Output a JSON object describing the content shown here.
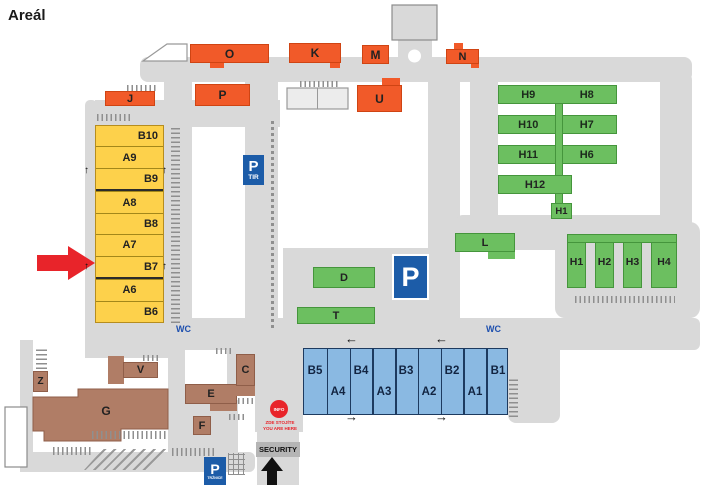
{
  "title": "Areál",
  "halls": {
    "orange": {
      "j": "J",
      "o": "O",
      "k": "K",
      "m": "M",
      "n": "N",
      "p": "P",
      "u": "U"
    },
    "yellow_rows": [
      "B10",
      "A9",
      "B9",
      "A8",
      "B8",
      "A7",
      "B7",
      "A6",
      "B6"
    ],
    "green": {
      "row1_left": "H9",
      "row1_right": "H8",
      "row2_left": "H10",
      "row2_right": "H7",
      "row3_left": "H11",
      "row3_right": "H6",
      "row4": "H12",
      "h1_small": "H1",
      "l": "L",
      "d": "D",
      "t": "T",
      "comb": [
        "H1",
        "H2",
        "H3",
        "H4"
      ]
    },
    "blue_sections": [
      "B5",
      "A4",
      "B4",
      "A3",
      "B3",
      "A2",
      "B2",
      "A1",
      "B1"
    ],
    "brown": {
      "z": "Z",
      "v": "V",
      "g": "G",
      "e": "E",
      "c": "C",
      "f": "F"
    }
  },
  "signs": {
    "parking_tir": {
      "symbol": "P",
      "caption": "TIR"
    },
    "parking_main": {
      "symbol": "P"
    },
    "parking_entrance": {
      "symbol": "P",
      "caption": "TRŽNICE"
    },
    "security": "SECURITY",
    "info": {
      "badge": "INFO",
      "line1": "ZDE STOJÍTE",
      "line2": "YOU ARE HERE"
    },
    "wc_left": "WC",
    "wc_right": "WC"
  },
  "icons": {
    "up_arrow": "↑",
    "left_arrow": "←",
    "right_arrow": "→"
  },
  "colors": {
    "orange": "#f15a29",
    "yellow": "#fdd14b",
    "green": "#6cbf60",
    "blue_hall": "#8ab9e2",
    "brown": "#b07d66",
    "road": "#d9d9d9",
    "parking_blue": "#1c5ca8",
    "alert_red": "#e8242a",
    "wc_blue": "#1d4fae"
  }
}
